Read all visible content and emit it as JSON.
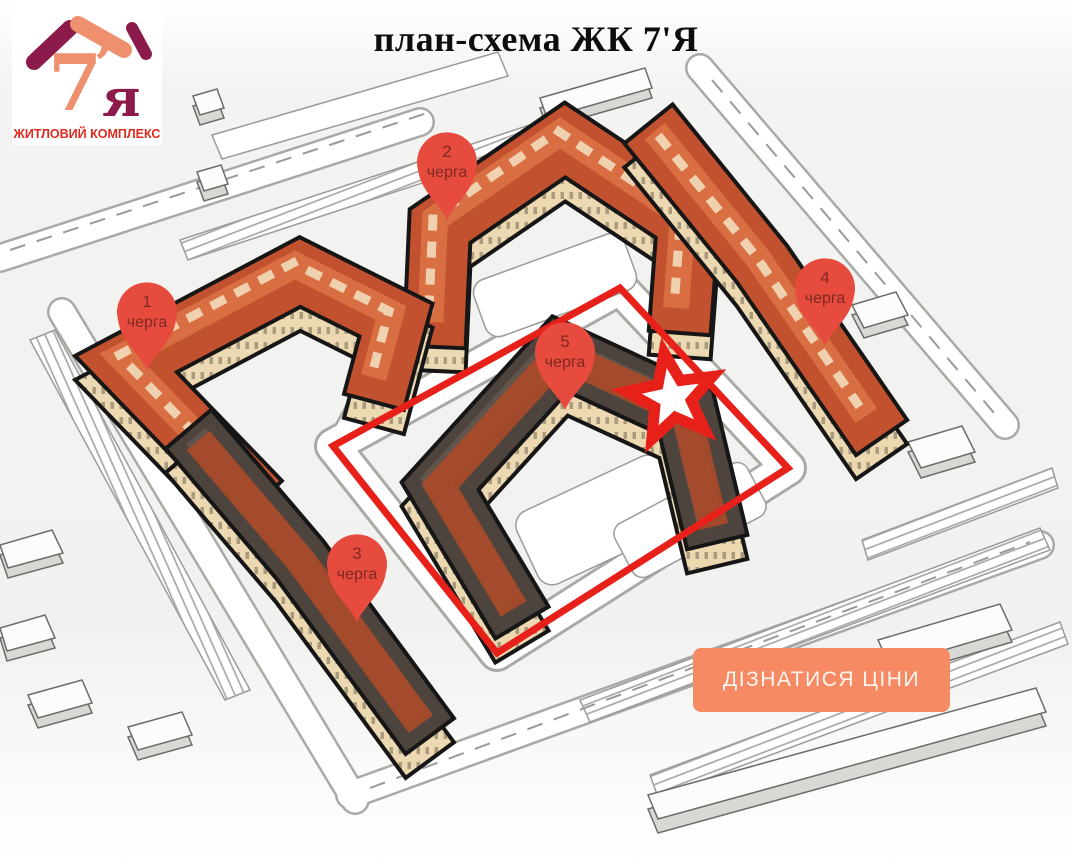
{
  "header": {
    "title": "план-схема ЖК 7'Я",
    "logo": {
      "glyph_7": "7",
      "glyph_apostrophe": "’",
      "glyph_ya": "я",
      "subtitle": "ЖИТЛОВИЙ КОМПЛЕКС"
    }
  },
  "map": {
    "markers": [
      {
        "number": "1",
        "label": "черга"
      },
      {
        "number": "2",
        "label": "черга"
      },
      {
        "number": "3",
        "label": "черга"
      },
      {
        "number": "4",
        "label": "черга"
      },
      {
        "number": "5",
        "label": "черга"
      }
    ],
    "highlighted_phase": "5"
  },
  "cta": {
    "label": "ДІЗНАТИСЯ ЦІНИ"
  },
  "colors": {
    "pin": "#e74b3e",
    "pin_text": "#7d2a22",
    "highlight_red": "#e8201a",
    "cta_background": "#f58a64",
    "cta_text": "#fdf6f0",
    "roof_terracotta": "#c2512f",
    "roof_terracotta_light": "#d96e42",
    "roof_dark": "#4d443d",
    "wall_cream": "#ecd9b2",
    "logo_salmon": "#ee8f6e",
    "logo_maroon": "#8c1b4b",
    "logo_subtitle_red": "#e02a1f"
  }
}
